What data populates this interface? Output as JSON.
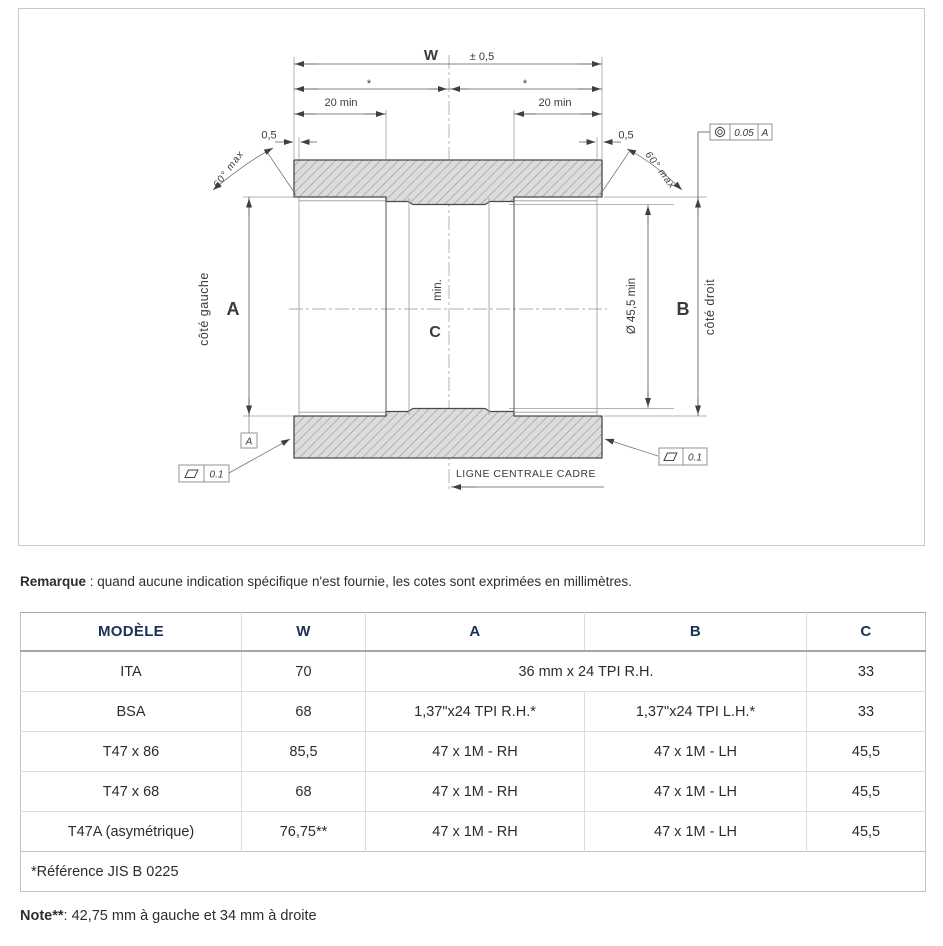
{
  "colors": {
    "table_header_text": "#1b3156",
    "hatch_fill": "#dcdcdc",
    "line_dark": "#4a4a4a"
  },
  "drawing": {
    "labels": {
      "width": "W",
      "width_tol": "± 0,5",
      "half_mark_left": "*",
      "half_mark_right": "*",
      "thread_depth_left": "20 min",
      "thread_depth_right": "20 min",
      "face_relief_left": "0,5",
      "face_relief_right": "0,5",
      "chamfer_left": "60° max",
      "chamfer_right": "60° max",
      "side_left": "côté gauche",
      "side_right": "côté droit",
      "dim_a": "A",
      "dim_b": "B",
      "dim_c": "C",
      "dim_c_min": "min.",
      "bore_right": "Ø 45,5 min",
      "centerline": "LIGNE CENTRALE CADRE",
      "datum": "A",
      "flatness_left": "0.1",
      "flatness_right": "0.1",
      "concentricity_tol": "0.05",
      "concentricity_datum": "A"
    }
  },
  "remark": {
    "label": "Remarque",
    "text": " : quand aucune indication spécifique n'est fournie, les cotes sont exprimées en millimètres."
  },
  "table": {
    "headers": [
      "MODÈLE",
      "W",
      "A",
      "B",
      "C"
    ],
    "rows": [
      {
        "model": "ITA",
        "w": "70",
        "a": "36 mm x 24 TPI R.H.",
        "b": null,
        "c": "33"
      },
      {
        "model": "BSA",
        "w": "68",
        "a": "1,37\"x24 TPI R.H.*",
        "b": "1,37\"x24 TPI L.H.*",
        "c": "33"
      },
      {
        "model": "T47 x 86",
        "w": "85,5",
        "a": "47 x 1M - RH",
        "b": "47 x 1M - LH",
        "c": "45,5"
      },
      {
        "model": "T47 x 68",
        "w": "68",
        "a": "47 x 1M - RH",
        "b": "47 x 1M - LH",
        "c": "45,5"
      },
      {
        "model": "T47A (asymétrique)",
        "w": "76,75**",
        "a": "47 x 1M - RH",
        "b": "47 x 1M - LH",
        "c": "45,5"
      }
    ],
    "footnote": "*Référence  JIS B 0225"
  },
  "note": {
    "label": "Note**",
    "text": ": 42,75 mm à gauche et 34 mm à droite"
  }
}
